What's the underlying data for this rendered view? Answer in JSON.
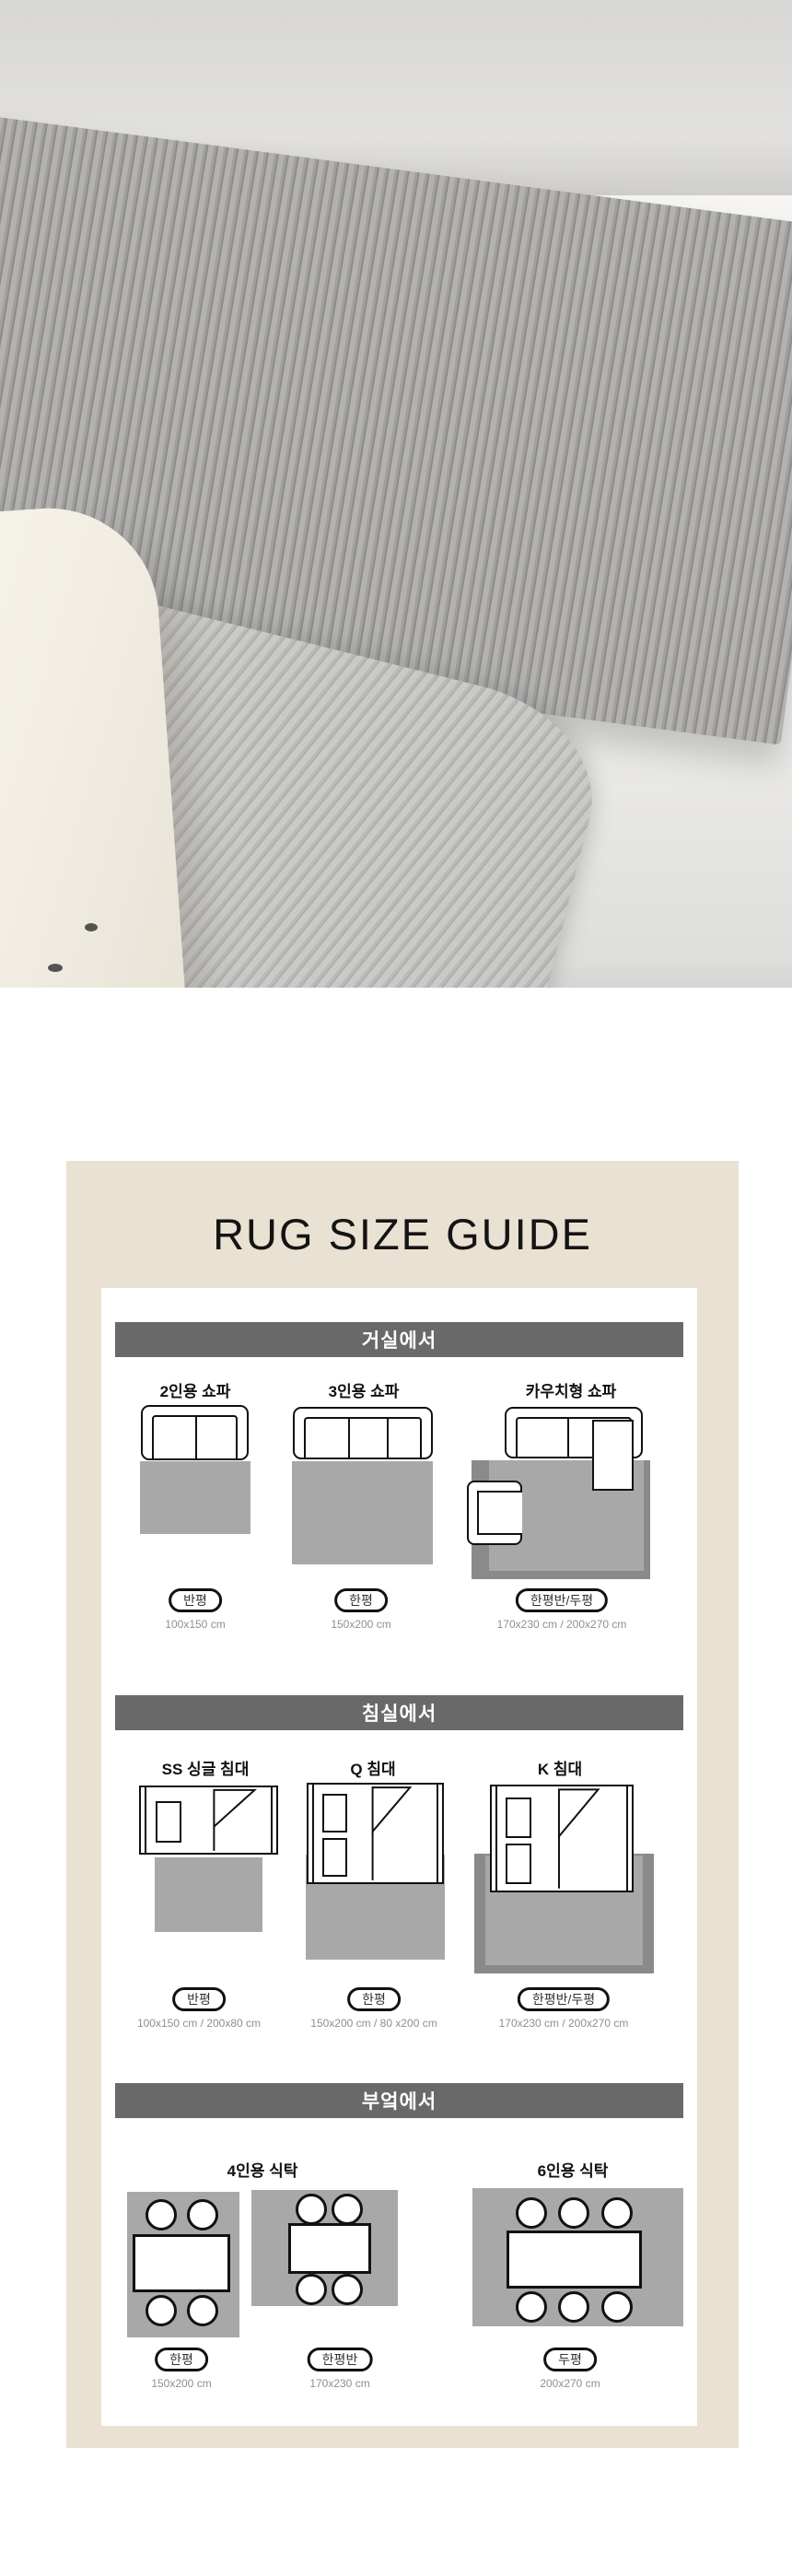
{
  "guide": {
    "title": "RUG SIZE GUIDE"
  },
  "sections": [
    {
      "id": "living-room",
      "header": "거실에서",
      "columns": [
        {
          "label": "2인용 쇼파",
          "badge": "반평",
          "size": "100x150 cm"
        },
        {
          "label": "3인용 쇼파",
          "badge": "한평",
          "size": "150x200 cm"
        },
        {
          "label": "카우치형 쇼파",
          "badge": "한평반/두평",
          "size": "170x230 cm / 200x270 cm"
        }
      ]
    },
    {
      "id": "bedroom",
      "header": "침실에서",
      "columns": [
        {
          "label": "SS 싱글 침대",
          "badge": "반평",
          "size": "100x150 cm / 200x80 cm"
        },
        {
          "label": "Q 침대",
          "badge": "한평",
          "size": "150x200 cm / 80 x200 cm"
        },
        {
          "label": "K 침대",
          "badge": "한평반/두평",
          "size": "170x230 cm / 200x270 cm"
        }
      ]
    },
    {
      "id": "kitchen",
      "header": "부엌에서",
      "labels": [
        "4인용 식탁",
        "6인용 식탁"
      ],
      "columns": [
        {
          "badge": "한평",
          "size": "150x200 cm"
        },
        {
          "badge": "한평반",
          "size": "170x230 cm"
        },
        {
          "badge": "두평",
          "size": "200x270 cm"
        }
      ]
    }
  ],
  "colors": {
    "panel_beige": "#e9e1d2",
    "section_bar_gray": "#696969",
    "rug_gray": "#a8a8a8",
    "rug_dark_gray": "#8a8a8a",
    "size_text_gray": "#8f8f8f",
    "line_black": "#111111"
  }
}
